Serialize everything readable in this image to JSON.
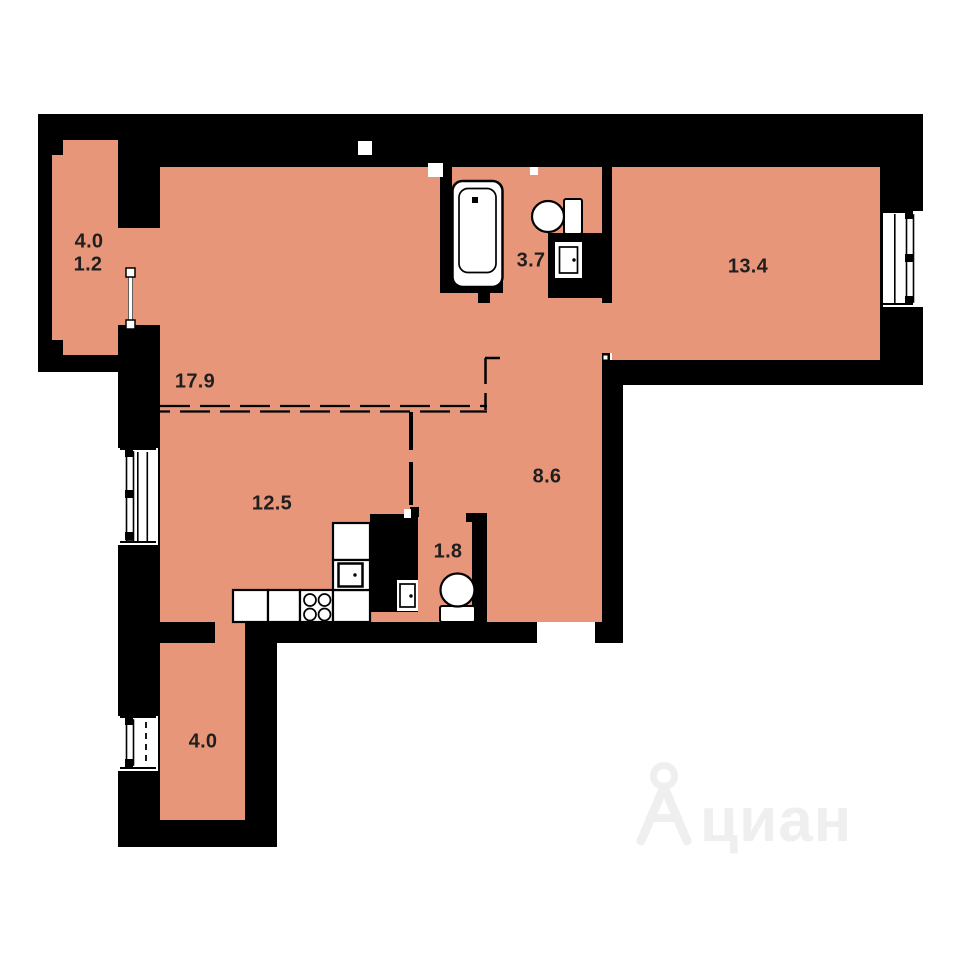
{
  "floor_plan": {
    "rooms": {
      "loggia_top": {
        "area_total": "4.0",
        "area_reduced": "1.2"
      },
      "hallway": {
        "area": "17.9"
      },
      "bathroom": {
        "area": "3.7"
      },
      "bedroom": {
        "area": "13.4"
      },
      "kitchen_living": {
        "area": "12.5"
      },
      "corridor": {
        "area": "8.6"
      },
      "wc": {
        "area": "1.8"
      },
      "loggia_bottom": {
        "area": "4.0"
      }
    },
    "icons": [
      "bathtub",
      "toilet",
      "sink",
      "stove-burners",
      "kitchen-counter",
      "window",
      "balcony-door",
      "entrance-opening",
      "dashed-partition"
    ],
    "colors": {
      "room_fill": "#E8967A",
      "wall": "#000000",
      "label_text": "#1F1F1F",
      "watermark": "#EFEFEF",
      "background": "#FFFFFF"
    }
  },
  "watermark": {
    "brand": "циан"
  }
}
